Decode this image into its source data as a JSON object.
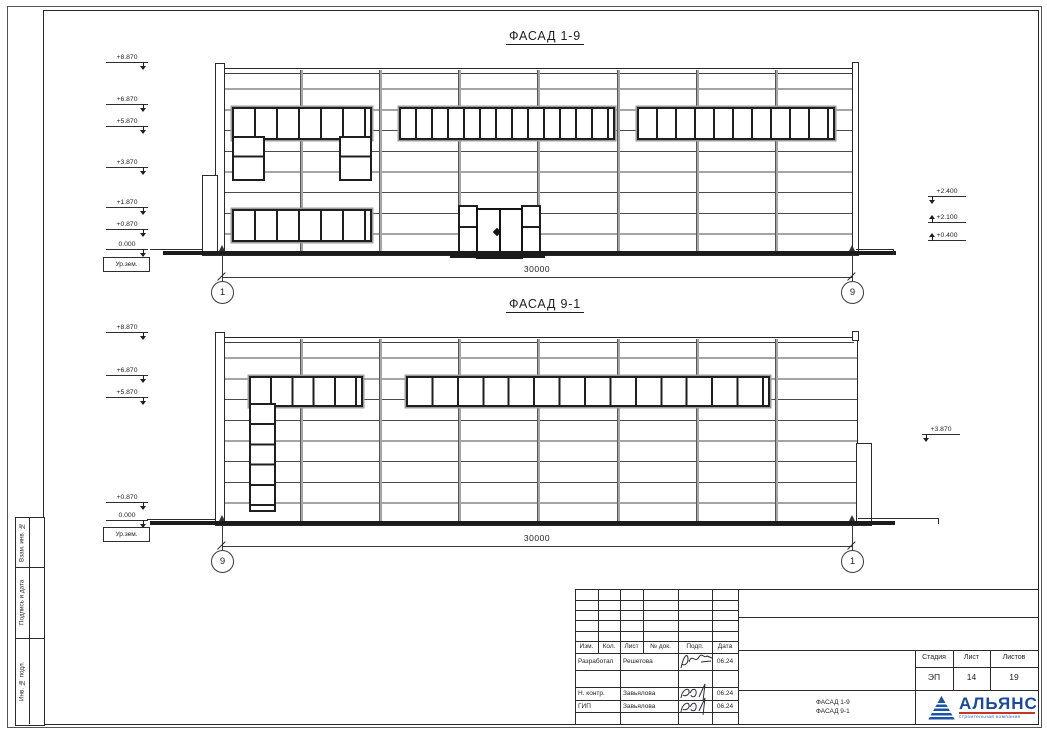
{
  "drawings": [
    {
      "title": "ФАСАД 1-9",
      "axis_left": "1",
      "axis_right": "9",
      "span_dimension": "30000",
      "elevations_left": [
        "+8.870",
        "+6.870",
        "+5.870",
        "+3.870",
        "+1.870",
        "+0.870",
        "0.000"
      ],
      "ground_label": "Ур.зем.",
      "elevations_right": [
        "+2.400",
        "+2.100",
        "+0.400"
      ]
    },
    {
      "title": "ФАСАД 9-1",
      "axis_left": "9",
      "axis_right": "1",
      "span_dimension": "30000",
      "elevations_left": [
        "+8.870",
        "+6.870",
        "+5.870",
        "+0.870",
        "0.000"
      ],
      "ground_label": "Ур.зем.",
      "elevations_right": [
        "+3.870"
      ]
    }
  ],
  "frame_labels": {
    "vert1": "Взам. инв. №",
    "vert2": "Подпись и дата",
    "vert3": "Инв. № подл."
  },
  "title_block": {
    "columns": [
      "Изм.",
      "Кол.",
      "Лист",
      "№ док.",
      "Подп.",
      "Дата"
    ],
    "signature_rows": [
      {
        "role": "Разработал",
        "name": "Решетова",
        "date": "06.24"
      },
      {
        "role": "Н. контр.",
        "name": "Завьялова",
        "date": "06.24"
      },
      {
        "role": "ГИП",
        "name": "Завьялова",
        "date": "06.24"
      }
    ],
    "stage_label": "Стадия",
    "sheet_label": "Лист",
    "sheets_label": "Листов",
    "stage_value": "ЭП",
    "sheet_value": "14",
    "sheets_value": "19",
    "doc_title_line1": "ФАСАД 1-9",
    "doc_title_line2": "ФАСАД 9-1",
    "company_name": "АЛЬЯНС",
    "company_tagline": "строительная компания",
    "brand_blue": "#1c4a9b",
    "brand_red": "#c2372c"
  }
}
